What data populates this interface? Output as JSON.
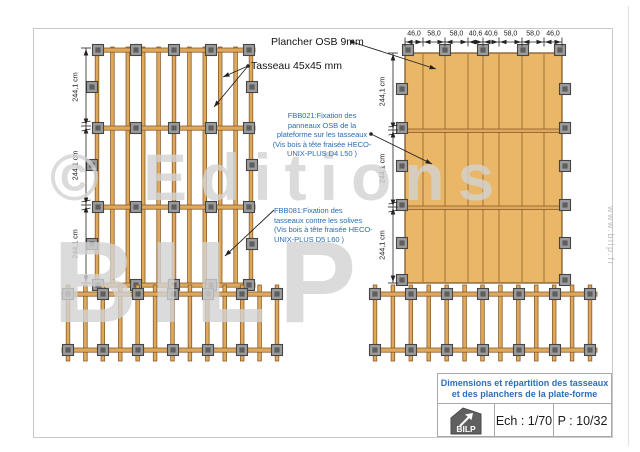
{
  "watermark": {
    "line1": "© Editions",
    "line2": "BILP",
    "url_vertical": "www.bilp.fr"
  },
  "annotations": {
    "plancher_label": "Plancher OSB 9mm",
    "tasseau_label": "Tasseau 45x45 mm",
    "fbb021": {
      "lines": [
        "FBB021:Fixation des",
        "panneaux OSB de la",
        "plateforme sur les tasseaux",
        "(Vis bois à tête fraisée HECO-",
        "UNIX-PLUS  D4 L50 )"
      ]
    },
    "fbb081": {
      "lines": [
        "FBB081:Fixation des",
        "tasseaux contre les solives",
        "(Vis bois à tête fraisée HECO-",
        "UNIX-PLUS D5 L60  )"
      ]
    }
  },
  "dimensions": {
    "section_label": "244,1 cm",
    "top_spans": [
      "46,0",
      "58,0",
      "58,0",
      "40,6",
      "40,6",
      "58,0",
      "58,0",
      "46,0"
    ]
  },
  "title_block": {
    "title_line1": "Dimensions et répartition des tasseaux",
    "title_line2": "et des planchers de la plate-forme",
    "scale": "Ech : 1/70",
    "page_num": "P : 10/32",
    "logo_text": "BILP"
  },
  "colors": {
    "wood": "#dfa95c",
    "wood_border": "#8a5a28",
    "osb": "#eab768",
    "osb_border": "#7a5220",
    "osb_seam": "#a87f3e",
    "clip_fill": "#9c9c9c",
    "clip_border": "#454545",
    "clip_inner": "#5e5e5e",
    "line": "#222222",
    "annotation_blue": "#2d6fb5",
    "watermark_gray": "#d3d3d3"
  }
}
